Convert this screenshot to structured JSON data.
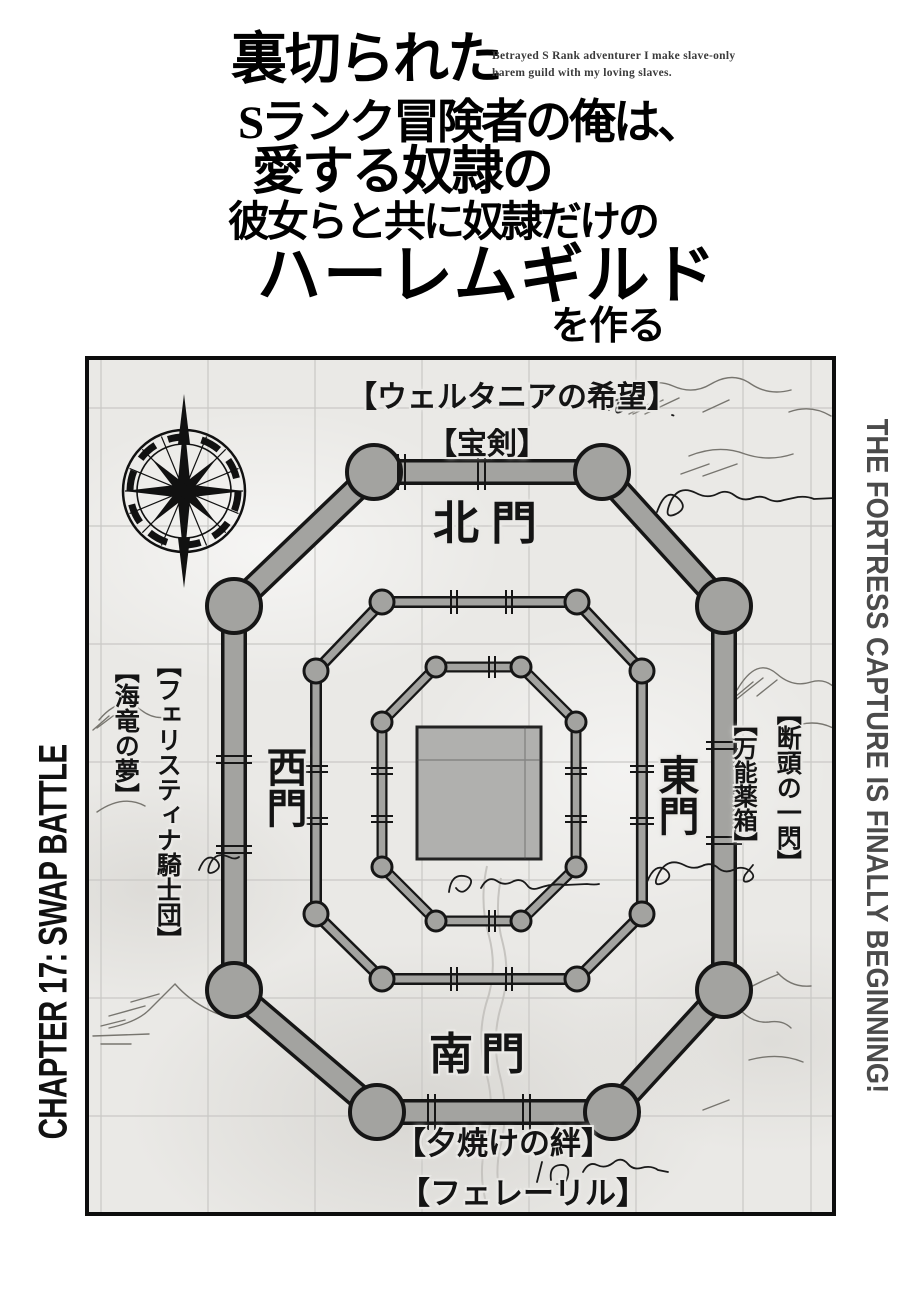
{
  "manga_title": {
    "line1": "裏切られた",
    "line2": "Sランク冒険者の俺は、",
    "line3": "愛する奴隷の",
    "line4": "彼女らと共に奴隷だけの",
    "line5": "ハーレムギルド",
    "line6": "を作る",
    "english_subtitle_line1": "Betrayed S Rank adventurer I make slave-only",
    "english_subtitle_line2": "harem guild with my loving slaves."
  },
  "captions": {
    "chapter": "CHAPTER 17: SWAP BATTLE",
    "tagline": "THE FORTRESS CAPTURE IS FINALLY BEGINNING!"
  },
  "map": {
    "labels": {
      "top_name": "【ウェルタニアの希望】",
      "top_item": "【宝剣】",
      "north_gate": "北門",
      "west_gate": "西門",
      "east_gate": "東門",
      "south_gate": "南門",
      "west_label_1": "【フェリスティナ騎士団】",
      "west_label_2": "【海竜の夢】",
      "east_label_1": "【断頭の一閃】",
      "east_label_2": "【万能薬箱】",
      "south_label_1": "【夕焼けの絆】",
      "south_label_2": "【フェレーリル】"
    },
    "colors": {
      "paper": "#eae9e6",
      "grid_line": "#c9c8c5",
      "wall_fill": "#a3a3a0",
      "wall_outline": "#161616",
      "keep_fill": "#b0b0ae",
      "sketch_ink": "#77756f",
      "label_ink": "#141414"
    }
  },
  "colors": {
    "page_background": "#ffffff",
    "chapter_text": "#111111",
    "tagline_text": "#4b4b4b"
  }
}
